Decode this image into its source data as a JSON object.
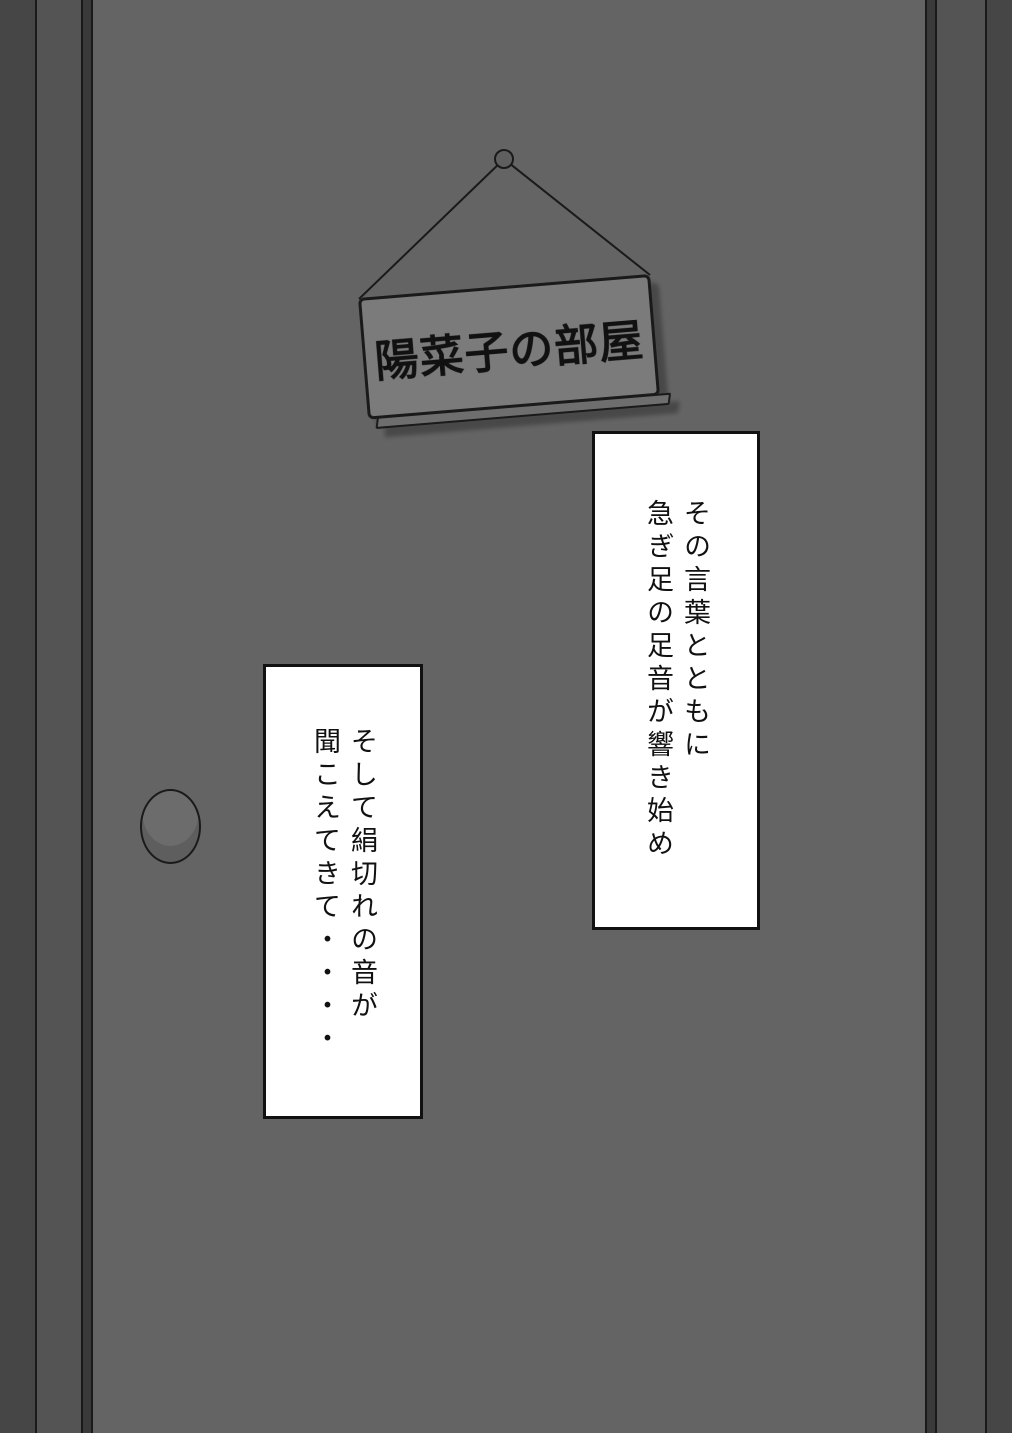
{
  "colors": {
    "wall": "#464646",
    "frame": "#545454",
    "groove": "#3a3a3a",
    "door": "#646464",
    "edge_line": "#1a1a1a",
    "sign_face": "#7b7b7b",
    "sign_side": "#6e6e6e",
    "knob": "#6c6c6c",
    "caption_bg": "#ffffff",
    "caption_border": "#111111",
    "text": "#111111"
  },
  "sign": {
    "label": "陽菜子の部屋"
  },
  "captions": [
    {
      "lines": [
        "その言葉とともに",
        "急ぎ足の足音が響き始め"
      ]
    },
    {
      "lines": [
        "そして絹切れの音が",
        "聞こえてきて・・・・"
      ]
    }
  ]
}
